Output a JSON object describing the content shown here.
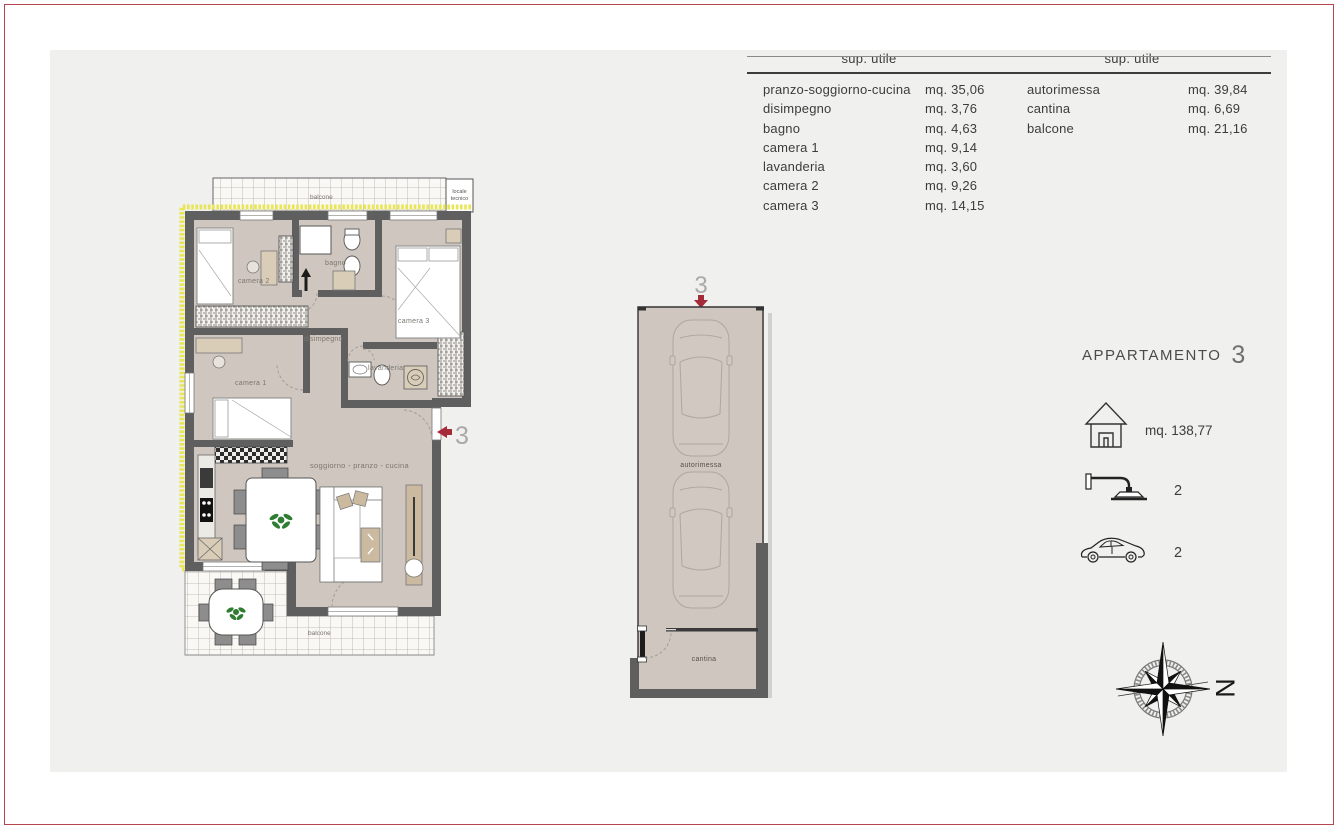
{
  "summary_tables": {
    "apartment": {
      "header": "sup. utile",
      "rows": [
        {
          "label": "pranzo-soggiorno-cucina",
          "value": "mq. 35,06"
        },
        {
          "label": "disimpegno",
          "value": "mq. 3,76"
        },
        {
          "label": "bagno",
          "value": "mq. 4,63"
        },
        {
          "label": "camera 1",
          "value": "mq. 9,14"
        },
        {
          "label": "lavanderia",
          "value": "mq. 3,60"
        },
        {
          "label": "camera 2",
          "value": "mq. 9,26"
        },
        {
          "label": "camera 3",
          "value": "mq. 14,15"
        }
      ]
    },
    "accessory": {
      "header": "sup. utile",
      "rows": [
        {
          "label": "autorimessa",
          "value": "mq. 39,84"
        },
        {
          "label": "cantina",
          "value": "mq. 6,69"
        },
        {
          "label": "balcone",
          "value": "mq. 21,16"
        }
      ]
    }
  },
  "floor_plan": {
    "unit_marker": "3",
    "rooms": {
      "camera_2": "camera 2",
      "bagno": "bagno",
      "camera_3": "camera 3",
      "disimpegno": "disimpegno",
      "camera_1": "camera 1",
      "lavanderia": "lavanderia",
      "soggiorno": "soggiorno - pranzo - cucina",
      "balcone_top": "balcone",
      "balcone_bottom": "balcone",
      "locale_tecnico_line1": "locale",
      "locale_tecnico_line2": "tecnico"
    }
  },
  "garage_plan": {
    "unit_marker": "3",
    "autorimessa": "autorimessa",
    "cantina": "cantina"
  },
  "info_panel": {
    "title": "APPARTAMENTO",
    "unit_number": "3",
    "total_area": "mq. 138,77",
    "showers": "2",
    "cars": "2"
  },
  "compass": {
    "north": "N"
  },
  "colors": {
    "page_border_red": "#b5454e",
    "accent_red": "#a62b38",
    "wall_gray": "#5f5f5f",
    "floor_beige": "#cfc7bf",
    "insulation_yellow": "#e9e655",
    "plant_green": "#2e7d32",
    "panel_gray": "#f0f0ee"
  }
}
